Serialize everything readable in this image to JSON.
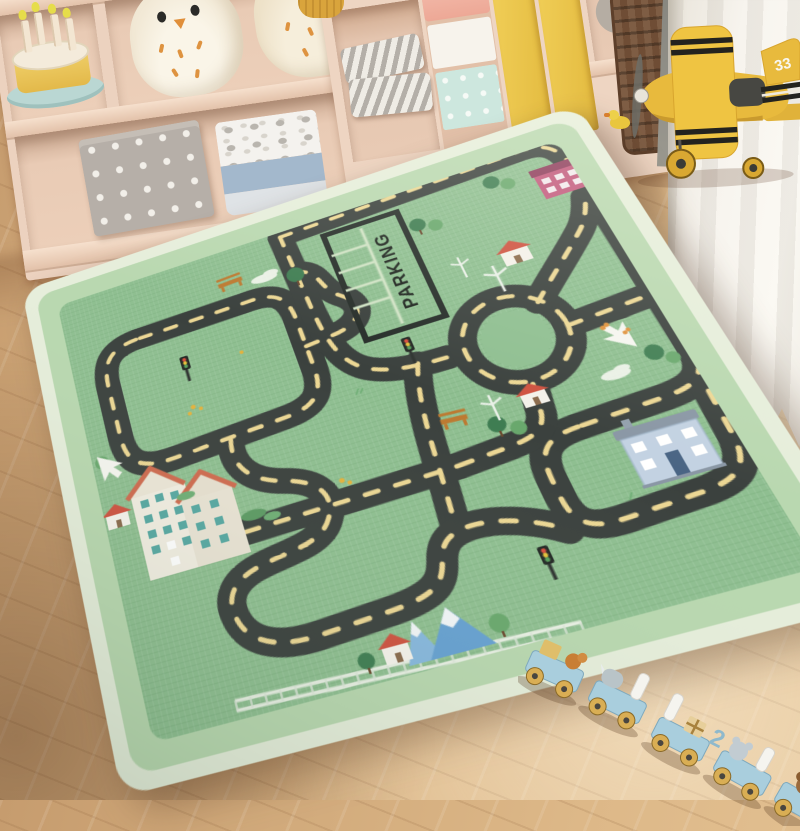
{
  "scene": {
    "type": "photograph",
    "setting": "children's playroom",
    "description": "Green road-map play rug on herringbone wood floor, toy shelves behind, yellow toy airplane by a white curtain, wooden animal train in front"
  },
  "rug": {
    "parking_label": "PARKING",
    "colors": {
      "field": "#8fbf91",
      "border_band": "#b9d8b0",
      "binding": "#e6eedb",
      "road": "#3b413e",
      "road_dash": "#ecd794"
    },
    "features": [
      "looping roads",
      "roundabout",
      "parking lot",
      "houses",
      "apartment building",
      "trees",
      "mountains",
      "railway",
      "wind turbines",
      "traffic lights",
      "benches",
      "clouds",
      "white arrows",
      "red car",
      "butterflies"
    ]
  },
  "toys": {
    "airplane": {
      "tail_number": "33",
      "color": "#e8ba3d"
    },
    "train": {
      "number_label": "2",
      "car_count": 5,
      "color": "#a9cedd",
      "cargo": [
        "orange bird",
        "rhino",
        "candles",
        "gift box",
        "mouse",
        "squirrel"
      ]
    },
    "cake": {
      "candle_count": 4,
      "plate_color": "#bad7d3"
    },
    "owls": {
      "count": 2
    },
    "teddy_bear": {
      "count": 1
    },
    "rubber_duck": {
      "count": 1
    }
  },
  "shelf": {
    "left_unit_items": [
      "toy birthday cake",
      "owl plush",
      "owl plush",
      "polka-dot basket",
      "toy storage bin"
    ],
    "right_unit_items": [
      "chevron pillows",
      "pink bin",
      "white bin",
      "mint polka-dot box",
      "yellow cabinet doors",
      "teddy bear",
      "wicker basket"
    ]
  },
  "room": {
    "floor": "light oak herringbone",
    "curtain_color": "#f7f4ee",
    "shelf_color": "#ecd2bf"
  }
}
